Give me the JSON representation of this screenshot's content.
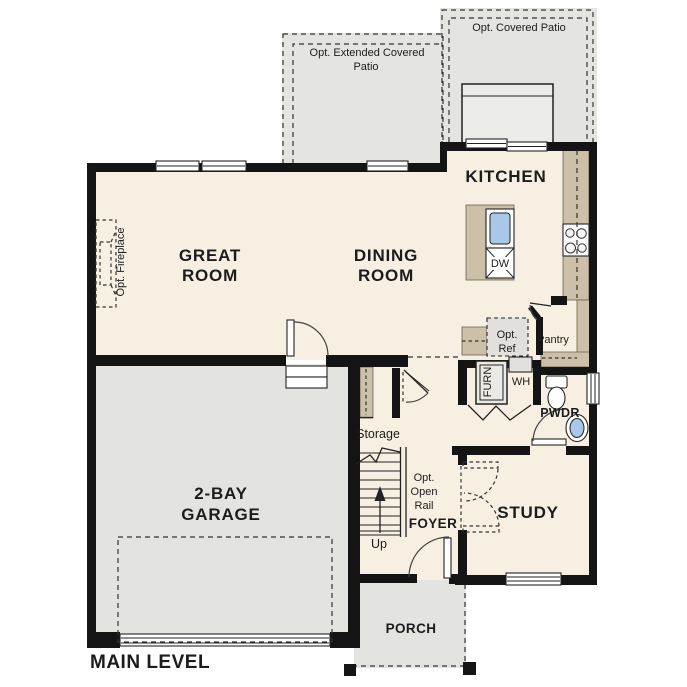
{
  "title": "MAIN LEVEL",
  "colors": {
    "wall": "#141414",
    "floor": "#f7efe1",
    "patio": "#e4e4e1",
    "garage": "#e3e3e0",
    "casework": "#cdc0a8",
    "water": "#a9c7e6",
    "equipment": "#e1e0dc",
    "text": "#1c1c1c"
  },
  "rooms": {
    "great_room": {
      "lines": [
        "GREAT",
        "ROOM"
      ]
    },
    "dining_room": {
      "lines": [
        "DINING",
        "ROOM"
      ]
    },
    "kitchen": {
      "label": "KITCHEN"
    },
    "garage": {
      "lines": [
        "2-BAY",
        "GARAGE"
      ]
    },
    "study": {
      "label": "STUDY"
    },
    "foyer": {
      "label": "FOYER"
    },
    "powder": {
      "label": "PWDR"
    },
    "pantry": {
      "label": "Pantry"
    },
    "storage": {
      "label": "Storage"
    },
    "porch": {
      "label": "PORCH"
    }
  },
  "options": {
    "covered_patio": {
      "label": "Opt. Covered Patio"
    },
    "extended_patio": {
      "lines": [
        "Opt. Extended Covered",
        "Patio"
      ]
    },
    "fireplace": {
      "label": "Opt. Fireplace"
    },
    "refrigerator": {
      "lines": [
        "Opt.",
        "Ref"
      ]
    },
    "open_rail": {
      "lines": [
        "Opt.",
        "Open",
        "Rail"
      ]
    }
  },
  "fixtures": {
    "furnace": "FURN",
    "water_heater": "WH",
    "dishwasher": "DW",
    "stair_direction": "Up"
  }
}
